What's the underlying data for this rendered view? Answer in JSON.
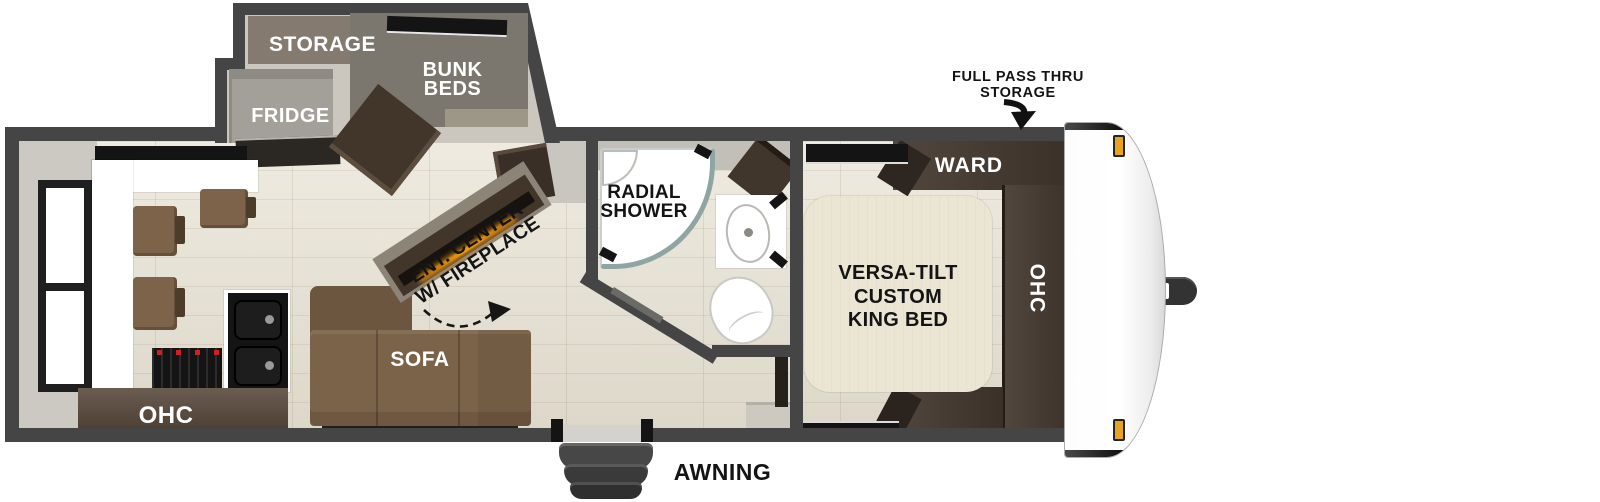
{
  "title": "Travel trailer floor plan",
  "annotations": {
    "full_pass_thru_line1": "FULL PASS THRU",
    "full_pass_thru_line2": "STORAGE",
    "awning": "AWNING"
  },
  "bump_out": {
    "storage_label": "STORAGE",
    "bunk_beds_line1": "BUNK",
    "bunk_beds_line2": "BEDS",
    "fridge_label": "FRIDGE"
  },
  "kitchen": {
    "ohc_label": "OHC"
  },
  "living": {
    "sofa_label": "SOFA",
    "ent_center_line1": "ENT. CENTER",
    "ent_center_line2": "W/ FIREPLACE"
  },
  "bathroom": {
    "shower_line1": "RADIAL",
    "shower_line2": "SHOWER"
  },
  "bedroom": {
    "ward_label": "WARD",
    "ohc_label": "OHC",
    "bed_line1": "VERSA-TILT",
    "bed_line2": "CUSTOM",
    "bed_line3": "KING BED"
  },
  "colors": {
    "wall": "#454545",
    "floor_plank": "#e8e3d4",
    "bumpout_floor": "#cbc7bf",
    "cabinet_dark_brown": "#42362b",
    "sofa_brown": "#7b6349",
    "bed_cream": "#ebe6d4",
    "fireplace_glow": "#f09a12",
    "marker_light_amber": "#e8a41f",
    "label_white": "#ffffff",
    "label_black": "#141414"
  }
}
